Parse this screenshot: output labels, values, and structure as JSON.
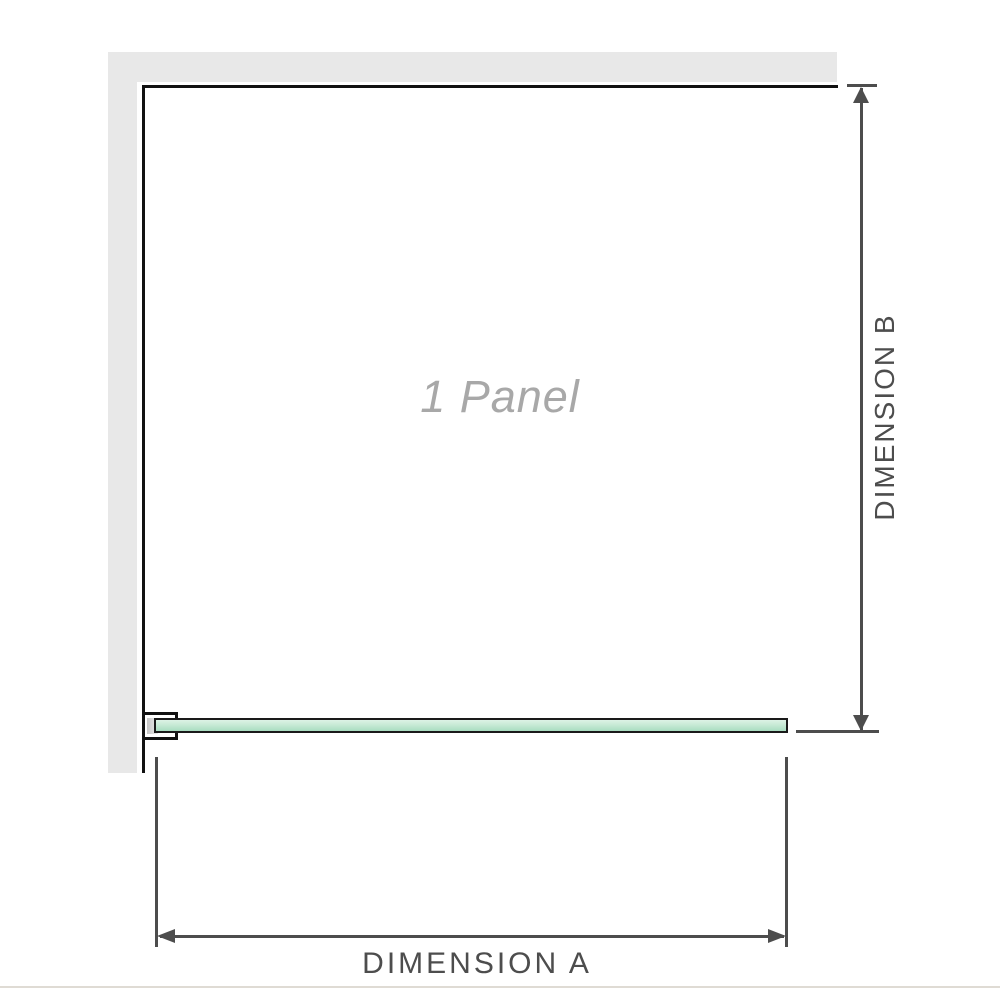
{
  "colors": {
    "wall_fill": "#e8e8e8",
    "wall_edge": "#111111",
    "glass_border": "#1a1a1a",
    "glass_fill_top": "#ddf2e5",
    "glass_fill_bottom": "#a9dcc0",
    "dimension_line": "#4d4d4d",
    "panel_label_color": "#a8a8a8",
    "baseline_color": "#dfdbd4"
  },
  "diagram": {
    "panel_label": "1 Panel",
    "dimension_a": {
      "label": "DIMENSION A"
    },
    "dimension_b": {
      "label": "DIMENSION B"
    }
  }
}
